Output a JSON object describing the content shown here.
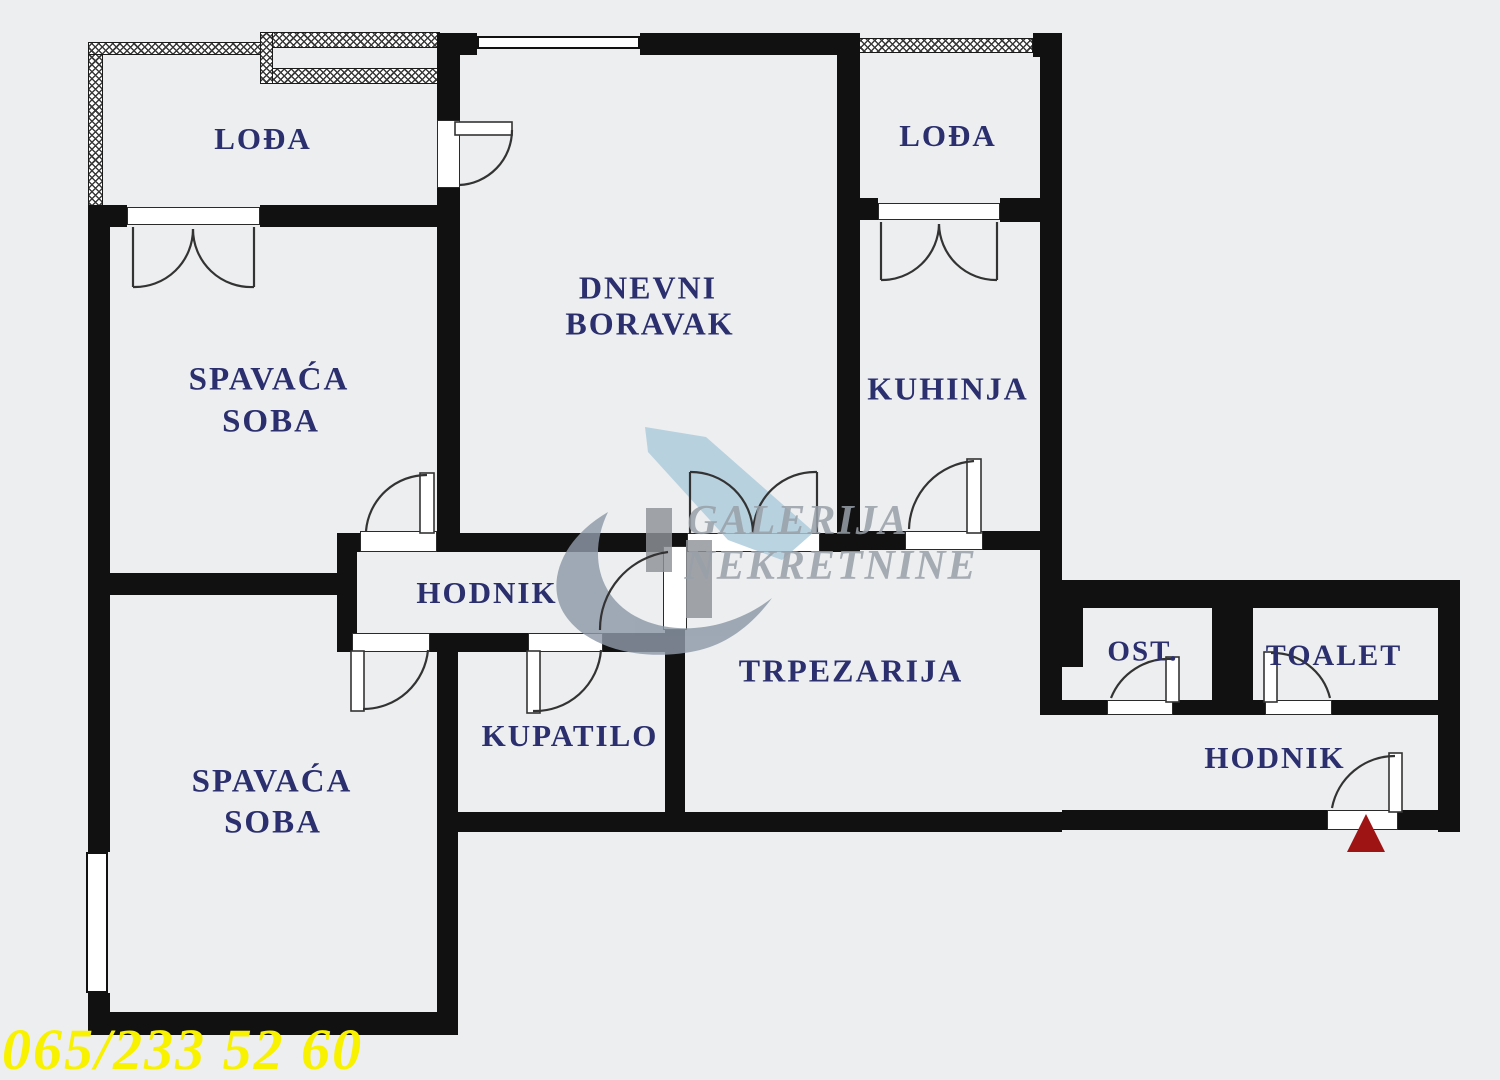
{
  "title": "Apartment floor plan",
  "rooms": {
    "loda_left": {
      "label": "LOĐA"
    },
    "loda_right": {
      "label": "LOĐA"
    },
    "dnevni": {
      "line1": "DNEVNI",
      "line2": "BORAVAK"
    },
    "kuhinja": {
      "label": "KUHINJA"
    },
    "spavaca_top": {
      "line1": "SPAVAĆA",
      "line2": "SOBA"
    },
    "hodnik_center": {
      "label": "HODNIK"
    },
    "trpezarija": {
      "label": "TRPEZARIJA"
    },
    "kupatilo": {
      "label": "KUPATILO"
    },
    "spavaca_bottom": {
      "line1": "SPAVAĆA",
      "line2": "SOBA"
    },
    "ost": {
      "label": "OST."
    },
    "toalet": {
      "label": "TOALET"
    },
    "hodnik_entry": {
      "label": "HODNIK"
    }
  },
  "watermark": {
    "line1": "GALERIJA",
    "line2": "NEKRETNINE"
  },
  "footer": {
    "phone": "065/233 52 60"
  },
  "colors": {
    "label_text": "#2b2f6e",
    "walls": "#111111",
    "phone_text": "#f8f100",
    "entrance_marker": "#9e1414",
    "watermark_text": "#99a0a8",
    "watermark_swoosh": "#8d99a7",
    "watermark_blade": "#accbdc",
    "background": "#eceef0"
  }
}
